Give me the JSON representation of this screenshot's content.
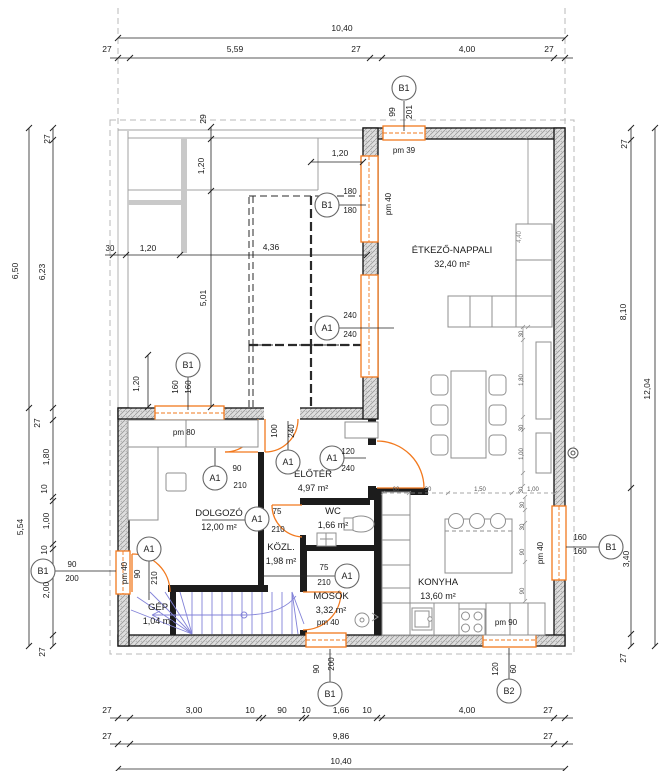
{
  "drawing_type": "floor-plan",
  "palette": {
    "opening_accent": "#f2791e",
    "stair_accent": "#8282d8",
    "wall_dark": "#1c1c1c",
    "furniture_gray": "#8f8f8f",
    "dim_color": "#1a1a1a",
    "structure_gray": "#a0a0a0"
  },
  "rooms": [
    {
      "name": "ÉTKEZŐ-NAPPALI",
      "area": "32,40 m²",
      "x": 452,
      "y": 253
    },
    {
      "name": "DOLGOZÓ",
      "area": "12,00 m²",
      "x": 219,
      "y": 516
    },
    {
      "name": "ELŐTÉR",
      "area": "4,97 m²",
      "x": 313,
      "y": 477
    },
    {
      "name": "WC",
      "area": "1,66 m²",
      "x": 333,
      "y": 514
    },
    {
      "name": "KÖZL.",
      "area": "1,98 m²",
      "x": 281,
      "y": 550
    },
    {
      "name": "MOSÓK",
      "area": "3,32 m²",
      "x": 331,
      "y": 599
    },
    {
      "name": "KONYHA",
      "area": "13,60 m²",
      "x": 438,
      "y": 585
    },
    {
      "name": "GÉP",
      "area": "1,04 m²",
      "x": 158,
      "y": 610
    }
  ],
  "markers": [
    {
      "t": "B1",
      "x": 404,
      "y": 88
    },
    {
      "t": "B1",
      "x": 327,
      "y": 205
    },
    {
      "t": "A1",
      "x": 327,
      "y": 328
    },
    {
      "t": "B1",
      "x": 188,
      "y": 365
    },
    {
      "t": "B1",
      "x": 43,
      "y": 571
    },
    {
      "t": "A1",
      "x": 288,
      "y": 462
    },
    {
      "t": "A1",
      "x": 332,
      "y": 458
    },
    {
      "t": "A1",
      "x": 215,
      "y": 478
    },
    {
      "t": "A1",
      "x": 257,
      "y": 519
    },
    {
      "t": "A1",
      "x": 347,
      "y": 576
    },
    {
      "t": "A1",
      "x": 149,
      "y": 549
    },
    {
      "t": "B1",
      "x": 611,
      "y": 547
    },
    {
      "t": "B1",
      "x": 330,
      "y": 694
    },
    {
      "t": "B2",
      "x": 509,
      "y": 691
    }
  ],
  "labels": [
    {
      "t": "10,40",
      "x": 342,
      "y": 31
    },
    {
      "t": "27",
      "x": 107,
      "y": 52
    },
    {
      "t": "5,59",
      "x": 235,
      "y": 52
    },
    {
      "t": "27",
      "x": 356,
      "y": 52
    },
    {
      "t": "4,00",
      "x": 467,
      "y": 52
    },
    {
      "t": "27",
      "x": 549,
      "y": 52
    },
    {
      "t": "99",
      "x": 395,
      "y": 112,
      "r": 1
    },
    {
      "t": "201",
      "x": 412,
      "y": 112,
      "r": 1
    },
    {
      "t": "29",
      "x": 206,
      "y": 119,
      "r": 1
    },
    {
      "t": "27",
      "x": 50,
      "y": 139,
      "r": 1
    },
    {
      "t": "6,50",
      "x": 18,
      "y": 271,
      "r": 1
    },
    {
      "t": "6,23",
      "x": 45,
      "y": 272,
      "r": 1
    },
    {
      "t": "5,54",
      "x": 23,
      "y": 527,
      "r": 1
    },
    {
      "t": "27",
      "x": 40,
      "y": 423,
      "r": 1
    },
    {
      "t": "1,80",
      "x": 49,
      "y": 457,
      "r": 1
    },
    {
      "t": "10",
      "x": 47,
      "y": 489,
      "r": 1
    },
    {
      "t": "1,00",
      "x": 49,
      "y": 521,
      "r": 1
    },
    {
      "t": "10",
      "x": 47,
      "y": 550,
      "r": 1
    },
    {
      "t": "2,00",
      "x": 49,
      "y": 590,
      "r": 1
    },
    {
      "t": "27",
      "x": 45,
      "y": 652,
      "r": 1
    },
    {
      "t": "90",
      "x": 72,
      "y": 567,
      "s": 8
    },
    {
      "t": "200",
      "x": 72,
      "y": 581,
      "s": 8
    },
    {
      "t": "27",
      "x": 627,
      "y": 144,
      "r": 1
    },
    {
      "t": "8,10",
      "x": 626,
      "y": 312,
      "r": 1
    },
    {
      "t": "3,40",
      "x": 629,
      "y": 559,
      "r": 1
    },
    {
      "t": "27",
      "x": 626,
      "y": 658,
      "r": 1
    },
    {
      "t": "12,04",
      "x": 650,
      "y": 389,
      "r": 1
    },
    {
      "t": "160",
      "x": 580,
      "y": 540,
      "s": 8
    },
    {
      "t": "160",
      "x": 580,
      "y": 554,
      "s": 8
    },
    {
      "t": "pm 40",
      "x": 543,
      "y": 553,
      "r": 1,
      "s": 8
    },
    {
      "t": "27",
      "x": 107,
      "y": 713
    },
    {
      "t": "3,00",
      "x": 194,
      "y": 713
    },
    {
      "t": "10",
      "x": 250,
      "y": 713
    },
    {
      "t": "90",
      "x": 282,
      "y": 713
    },
    {
      "t": "10",
      "x": 306,
      "y": 713
    },
    {
      "t": "1,66",
      "x": 341,
      "y": 713
    },
    {
      "t": "10",
      "x": 367,
      "y": 713
    },
    {
      "t": "4,00",
      "x": 467,
      "y": 713
    },
    {
      "t": "27",
      "x": 548,
      "y": 713
    },
    {
      "t": "27",
      "x": 107,
      "y": 739
    },
    {
      "t": "9,86",
      "x": 341,
      "y": 739
    },
    {
      "t": "27",
      "x": 548,
      "y": 739
    },
    {
      "t": "10,40",
      "x": 341,
      "y": 764
    },
    {
      "t": "90",
      "x": 319,
      "y": 669,
      "r": 1,
      "s": 8
    },
    {
      "t": "200",
      "x": 334,
      "y": 664,
      "r": 1,
      "s": 8
    },
    {
      "t": "120",
      "x": 498,
      "y": 669,
      "r": 1,
      "s": 8
    },
    {
      "t": "60",
      "x": 516,
      "y": 669,
      "r": 1,
      "s": 8
    },
    {
      "t": "1,20",
      "x": 204,
      "y": 166,
      "r": 1
    },
    {
      "t": "1,20",
      "x": 340,
      "y": 156
    },
    {
      "t": "30",
      "x": 110,
      "y": 251,
      "s": 8
    },
    {
      "t": "1,20",
      "x": 148,
      "y": 251
    },
    {
      "t": "4,36",
      "x": 271,
      "y": 250
    },
    {
      "t": "5,01",
      "x": 206,
      "y": 298,
      "r": 1
    },
    {
      "t": "180",
      "x": 350,
      "y": 194,
      "s": 8
    },
    {
      "t": "180",
      "x": 350,
      "y": 213,
      "s": 8
    },
    {
      "t": "pm 40",
      "x": 391,
      "y": 204,
      "r": 1,
      "s": 8
    },
    {
      "t": "pm 39",
      "x": 404,
      "y": 153,
      "s": 8
    },
    {
      "t": "240",
      "x": 350,
      "y": 318,
      "s": 8
    },
    {
      "t": "240",
      "x": 350,
      "y": 337,
      "s": 8
    },
    {
      "t": "pm 80",
      "x": 184,
      "y": 435,
      "s": 8
    },
    {
      "t": "160",
      "x": 178,
      "y": 387,
      "r": 1,
      "s": 8
    },
    {
      "t": "160",
      "x": 191,
      "y": 387,
      "r": 1,
      "s": 8
    },
    {
      "t": "1,20",
      "x": 139,
      "y": 384,
      "r": 1,
      "s": 8
    },
    {
      "t": "100",
      "x": 277,
      "y": 431,
      "r": 1,
      "s": 8
    },
    {
      "t": "240",
      "x": 294,
      "y": 431,
      "r": 1,
      "s": 8
    },
    {
      "t": "90",
      "x": 237,
      "y": 471,
      "s": 8
    },
    {
      "t": "210",
      "x": 240,
      "y": 488,
      "s": 8
    },
    {
      "t": "120",
      "x": 348,
      "y": 454,
      "s": 8
    },
    {
      "t": "240",
      "x": 348,
      "y": 471,
      "s": 8
    },
    {
      "t": "75",
      "x": 277,
      "y": 514,
      "s": 8
    },
    {
      "t": "210",
      "x": 278,
      "y": 532,
      "s": 8
    },
    {
      "t": "75",
      "x": 324,
      "y": 570,
      "s": 8
    },
    {
      "t": "210",
      "x": 324,
      "y": 585,
      "s": 8
    },
    {
      "t": "90",
      "x": 140,
      "y": 574,
      "r": 1,
      "s": 8
    },
    {
      "t": "210",
      "x": 157,
      "y": 578,
      "r": 1,
      "s": 8
    },
    {
      "t": "pm 40",
      "x": 127,
      "y": 573,
      "r": 1,
      "s": 8
    },
    {
      "t": "pm 40",
      "x": 328,
      "y": 625,
      "s": 8
    },
    {
      "t": "pm 90",
      "x": 506,
      "y": 625,
      "s": 8
    },
    {
      "t": "60",
      "x": 396,
      "y": 491,
      "s": 6,
      "c": "#555"
    },
    {
      "t": "90",
      "x": 428,
      "y": 491,
      "s": 6,
      "c": "#555"
    },
    {
      "t": "1,50",
      "x": 480,
      "y": 491,
      "s": 6,
      "c": "#555"
    },
    {
      "t": "1,00",
      "x": 533,
      "y": 491,
      "s": 6,
      "c": "#555"
    },
    {
      "t": "30",
      "x": 524,
      "y": 505,
      "r": 1,
      "s": 6,
      "c": "#555"
    },
    {
      "t": "30",
      "x": 524,
      "y": 527,
      "r": 1,
      "s": 6,
      "c": "#555"
    },
    {
      "t": "90",
      "x": 524,
      "y": 552,
      "r": 1,
      "s": 6,
      "c": "#555"
    },
    {
      "t": "90",
      "x": 524,
      "y": 591,
      "r": 1,
      "s": 6,
      "c": "#555"
    },
    {
      "t": "30",
      "x": 523,
      "y": 334,
      "r": 1,
      "s": 6,
      "c": "#555"
    },
    {
      "t": "1,80",
      "x": 523,
      "y": 380,
      "r": 1,
      "s": 6,
      "c": "#555"
    },
    {
      "t": "30",
      "x": 523,
      "y": 428,
      "r": 1,
      "s": 6,
      "c": "#555"
    },
    {
      "t": "1,00",
      "x": 523,
      "y": 454,
      "r": 1,
      "s": 6,
      "c": "#555"
    },
    {
      "t": "30",
      "x": 523,
      "y": 490,
      "r": 1,
      "s": 6,
      "c": "#555"
    },
    {
      "t": "4,40",
      "x": 521,
      "y": 237,
      "r": 1,
      "s": 6,
      "c": "#8a8a8a"
    }
  ]
}
